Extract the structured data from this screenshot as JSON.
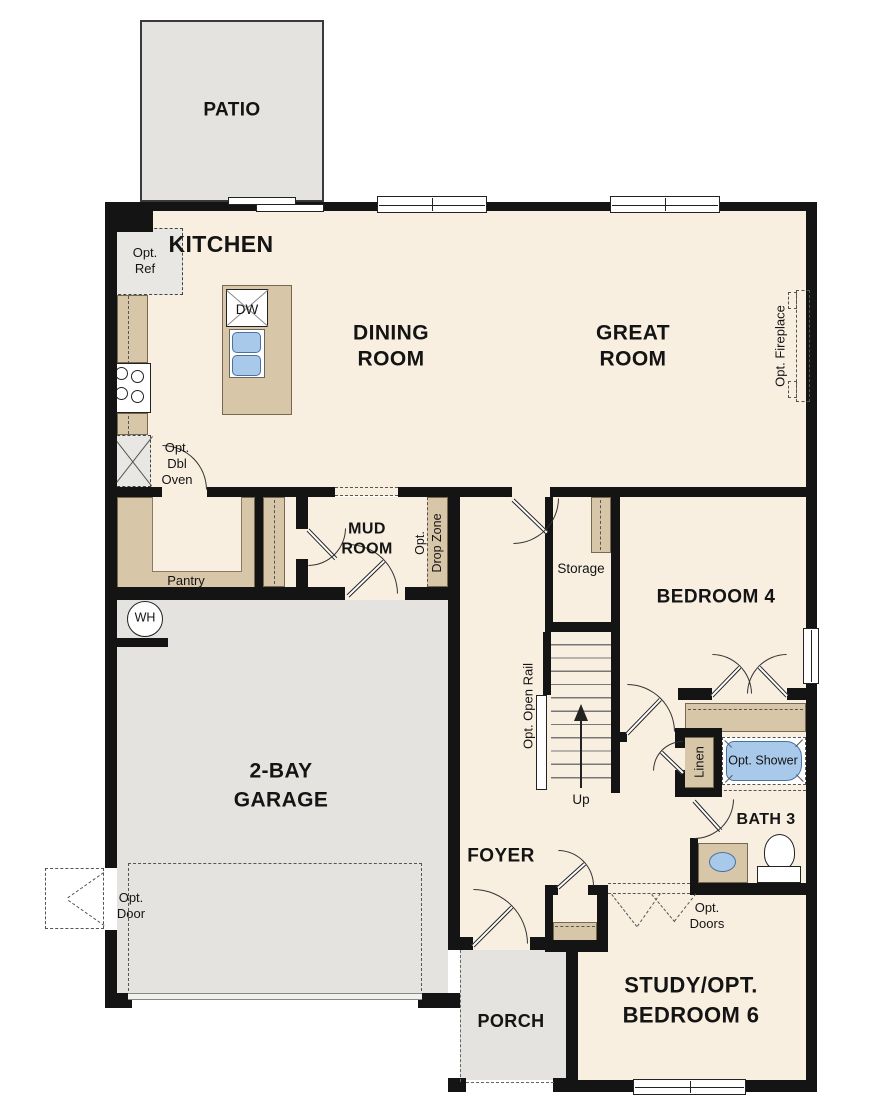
{
  "plan": {
    "rooms": {
      "patio": "PATIO",
      "kitchen": "KITCHEN",
      "dining": [
        "DINING",
        "ROOM"
      ],
      "great": [
        "GREAT",
        "ROOM"
      ],
      "mud": [
        "MUD",
        "ROOM"
      ],
      "garage": [
        "2-BAY",
        "GARAGE"
      ],
      "bedroom4": "BEDROOM 4",
      "foyer": "FOYER",
      "bath3": "BATH 3",
      "porch": "PORCH",
      "study": [
        "STUDY/OPT.",
        "BEDROOM 6"
      ],
      "storage": "Storage"
    },
    "features": {
      "opt_ref": [
        "Opt.",
        "Ref"
      ],
      "opt_dbl_oven": [
        "Opt.",
        "Dbl",
        "Oven"
      ],
      "dw": "DW",
      "pantry": "Pantry",
      "wh": "WH",
      "opt_drop_zone": [
        "Opt.",
        "Drop Zone"
      ],
      "opt_open_rail": "Opt. Open Rail",
      "up": "Up",
      "opt_fireplace": "Opt. Fireplace",
      "linen": "Linen",
      "opt_shower": "Opt. Shower",
      "opt_doors": [
        "Opt.",
        "Doors"
      ],
      "opt_door": [
        "Opt.",
        "Door"
      ]
    },
    "colors": {
      "floor": "#f8efe1",
      "exterior_concrete": "#e4e3e0",
      "cabinetry": "#d8c6a8",
      "plumbing_blue": "#a8c9e9",
      "wall": "#141414"
    }
  }
}
